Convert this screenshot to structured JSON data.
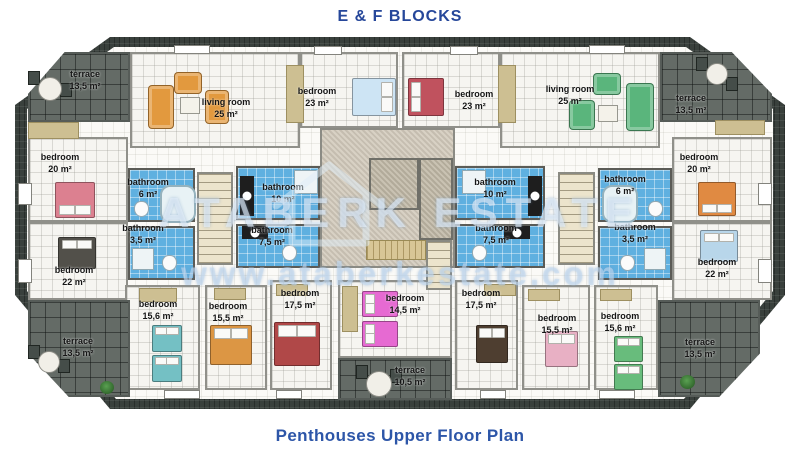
{
  "title": "E & F BLOCKS",
  "footer": "Penthouses Upper Floor Plan",
  "watermark": {
    "brand": "ATABERK ESTATE",
    "url": "www.ataberkestate.com",
    "logo": "house-outline-logo"
  },
  "colors": {
    "heading": "#26479a",
    "footer_color": "#2d56a8",
    "bathroom_floor": "#5fb0e0",
    "terrace_tile": "#646b66",
    "roof": "#39403c",
    "room_floor": "#f6f5f1",
    "sofa_left": "#e2993e",
    "sofa_right": "#5ab57c"
  },
  "rooms": [
    {
      "id": "terrace-top-left",
      "name": "terrace",
      "area": "13,5 m²"
    },
    {
      "id": "living-room-left",
      "name": "living room",
      "area": "25 m²"
    },
    {
      "id": "bedroom-top-left",
      "name": "bedroom",
      "area": "23 m²"
    },
    {
      "id": "bedroom-top-right",
      "name": "bedroom",
      "area": "23 m²"
    },
    {
      "id": "living-room-right",
      "name": "living room",
      "area": "25 m²"
    },
    {
      "id": "terrace-top-right",
      "name": "terrace",
      "area": "13,5 m²"
    },
    {
      "id": "bedroom-left-upper",
      "name": "bedroom",
      "area": "20 m²"
    },
    {
      "id": "bedroom-left-lower",
      "name": "bedroom",
      "area": "22 m²"
    },
    {
      "id": "bedroom-right-upper",
      "name": "bedroom",
      "area": "20 m²"
    },
    {
      "id": "bedroom-right-lower",
      "name": "bedroom",
      "area": "22 m²"
    },
    {
      "id": "bathroom-left-6",
      "name": "bathroom",
      "area": "6 m²"
    },
    {
      "id": "bathroom-left-3-5",
      "name": "bathroom",
      "area": "3,5 m²"
    },
    {
      "id": "bathroom-left-10",
      "name": "bathroom",
      "area": "10 m²"
    },
    {
      "id": "bathroom-left-7-5",
      "name": "bathroom",
      "area": "7,5 m²"
    },
    {
      "id": "bathroom-right-10",
      "name": "bathroom",
      "area": "10 m²"
    },
    {
      "id": "bathroom-right-7-5",
      "name": "bathroom",
      "area": "7,5 m²"
    },
    {
      "id": "bathroom-right-6",
      "name": "bathroom",
      "area": "6 m²"
    },
    {
      "id": "bathroom-right-3-5",
      "name": "bathroom",
      "area": "3,5 m²"
    },
    {
      "id": "bedroom-bottom-left-1",
      "name": "bedroom",
      "area": "15,6 m²"
    },
    {
      "id": "bedroom-bottom-left-2",
      "name": "bedroom",
      "area": "15,5 m²"
    },
    {
      "id": "bedroom-bottom-left-3",
      "name": "bedroom",
      "area": "17,5 m²"
    },
    {
      "id": "bedroom-bottom-center",
      "name": "bedroom",
      "area": "14,5 m²"
    },
    {
      "id": "terrace-bottom-center",
      "name": "terrace",
      "area": "10,5 m²"
    },
    {
      "id": "bedroom-bottom-right-3",
      "name": "bedroom",
      "area": "17,5 m²"
    },
    {
      "id": "bedroom-bottom-right-2",
      "name": "bedroom",
      "area": "15,5 m²"
    },
    {
      "id": "bedroom-bottom-right-1",
      "name": "bedroom",
      "area": "15,6 m²"
    },
    {
      "id": "terrace-bottom-left",
      "name": "terrace",
      "area": "13,5 m²"
    },
    {
      "id": "terrace-bottom-right",
      "name": "terrace",
      "area": "13,5 m²"
    }
  ]
}
